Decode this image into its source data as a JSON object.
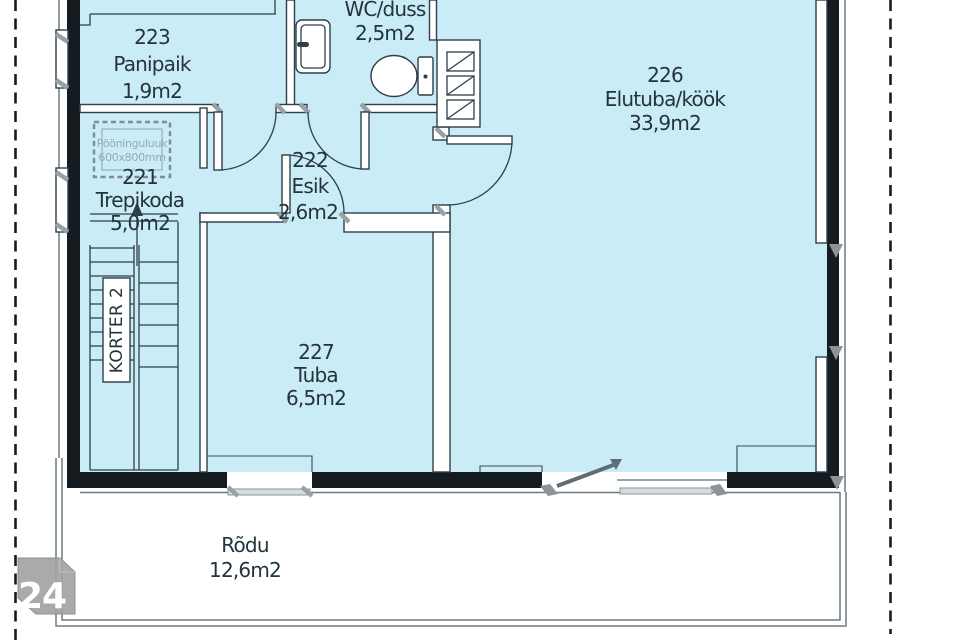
{
  "plan": {
    "marker": {
      "number": "24"
    },
    "apartment_label": "KORTER 2",
    "attic_hatch": {
      "line1": "Pööninguluuk",
      "line2": "600x800mm"
    },
    "rooms": {
      "panipaik": {
        "id": "223",
        "name": "Panipaik",
        "area": "1,9m2"
      },
      "wc": {
        "name": "WC/duss",
        "area": "2,5m2"
      },
      "elutuba": {
        "id": "226",
        "name": "Elutuba/köök",
        "area": "33,9m2"
      },
      "esik": {
        "id": "222",
        "name": "Esik",
        "area": "2,6m2"
      },
      "trepikoda": {
        "id": "221",
        "name": "Trepikoda",
        "area": "5,0m2"
      },
      "tuba": {
        "id": "227",
        "name": "Tuba",
        "area": "6,5m2"
      },
      "rodu": {
        "name": "Rõdu",
        "area": "12,6m2"
      }
    },
    "colors": {
      "room_fill": "#c9ecf6",
      "wall": "#141c22",
      "line": "#2e3f49",
      "text": "#24333c",
      "fixture_gray": "#8b9498",
      "marker_gray": "#a3a3a3"
    }
  }
}
